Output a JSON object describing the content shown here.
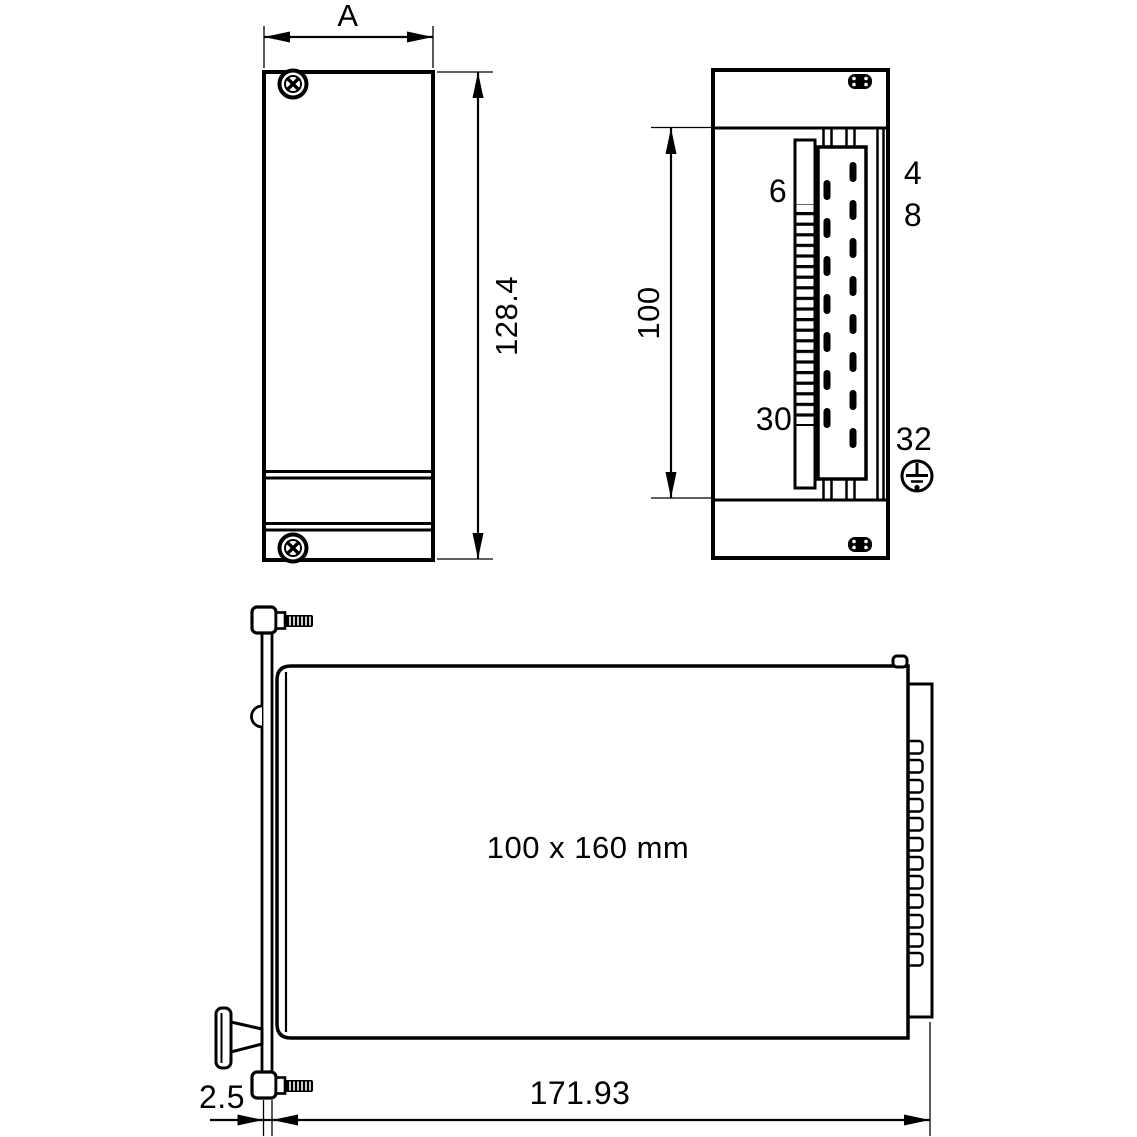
{
  "drawing": {
    "background": "#ffffff",
    "line_color": "#000000",
    "views": {
      "front": {
        "width_label": "A",
        "height_label": "128.4"
      },
      "rear": {
        "height_label": "100",
        "pin4": "4",
        "pin6": "6",
        "pin8": "8",
        "pin30": "30",
        "pin32": "32",
        "ground_icon": "protective-earth-symbol"
      },
      "side": {
        "board_label": "100 x 160 mm",
        "length_label": "171.93",
        "thickness_label": "2.5"
      }
    }
  }
}
